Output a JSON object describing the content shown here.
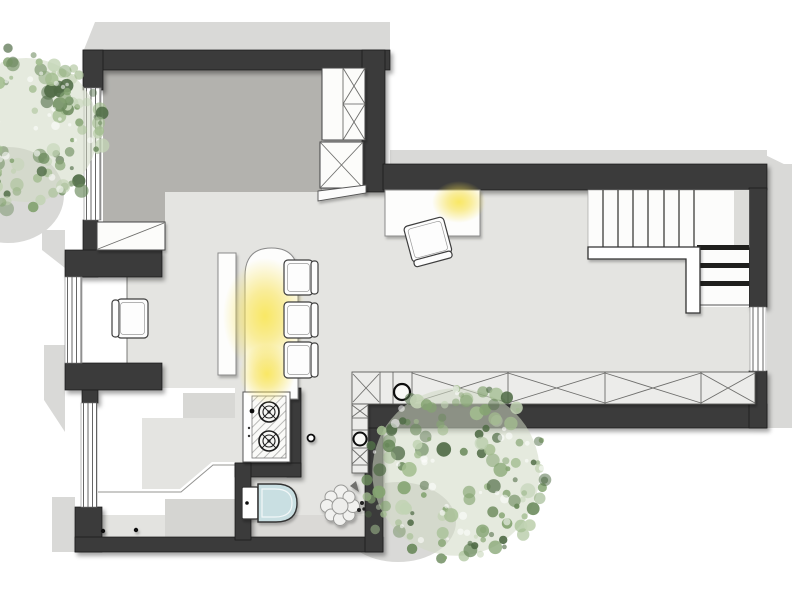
{
  "meta": {
    "title": "Apartment floor plan with kitchen island, staircase and WC",
    "canvas_width": 809,
    "canvas_height": 595
  },
  "palette": {
    "wall": "#3a3a3a",
    "floor_main": "#e4e4e1",
    "floor_bedroom": "#b3b2ae",
    "floor_entry": "#ffffff",
    "exterior_shadow": "#d9d9d7",
    "furniture_fill": "#fcfcfa",
    "counter_fill": "#ececea",
    "toilet_seat": "#c9dfe2",
    "glow": "#f6e04c",
    "tree_base": "#cfd9c3",
    "tree_colors": [
      "#4f6b45",
      "#6b8a5c",
      "#85a472",
      "#a3bd90",
      "#c2d3b4"
    ]
  },
  "elements": {
    "rooms": [
      {
        "name": "bedroom"
      },
      {
        "name": "living-kitchen"
      },
      {
        "name": "entry"
      },
      {
        "name": "wc"
      },
      {
        "name": "stair-hall"
      }
    ],
    "stairs": {
      "upper_steps": 8,
      "winder_steps": 3
    },
    "kitchen": {
      "island": 1,
      "bar_stools": 3,
      "cooktop_burners": 2,
      "sinks": 2,
      "counter_x_cells": 4
    },
    "wardrobe_x_cells": 3,
    "windows": 4,
    "trees": 2,
    "toilet": 1,
    "plant": 1,
    "ceiling_lights": 3
  },
  "chairs": [
    {
      "name": "desk-chair",
      "x": 408,
      "y": 221,
      "w": 41,
      "h": 42,
      "back": "bottom",
      "rot": -15
    },
    {
      "name": "armchair",
      "x": 112,
      "y": 299,
      "w": 36,
      "h": 39,
      "back": "left",
      "rot": 0
    },
    {
      "name": "bar-stool-1",
      "x": 284,
      "y": 260,
      "w": 34,
      "h": 35,
      "back": "right",
      "rot": 0
    },
    {
      "name": "bar-stool-2",
      "x": 284,
      "y": 302,
      "w": 34,
      "h": 36,
      "back": "right",
      "rot": 0
    },
    {
      "name": "bar-stool-3",
      "x": 284,
      "y": 342,
      "w": 34,
      "h": 36,
      "back": "right",
      "rot": 0
    }
  ],
  "glows": [
    {
      "name": "island-light-main",
      "cx": 265,
      "cy": 316,
      "rx": 42,
      "ry": 58
    },
    {
      "name": "island-light-lower",
      "cx": 267,
      "cy": 374,
      "rx": 28,
      "ry": 30
    },
    {
      "name": "desk-light",
      "cx": 459,
      "cy": 202,
      "rx": 27,
      "ry": 21
    }
  ],
  "trees": [
    {
      "name": "tree-top-left",
      "cx": 26,
      "cy": 130,
      "r": 80,
      "seed": 13
    },
    {
      "name": "tree-bottom",
      "cx": 456,
      "cy": 472,
      "r": 93,
      "seed": 77
    }
  ]
}
